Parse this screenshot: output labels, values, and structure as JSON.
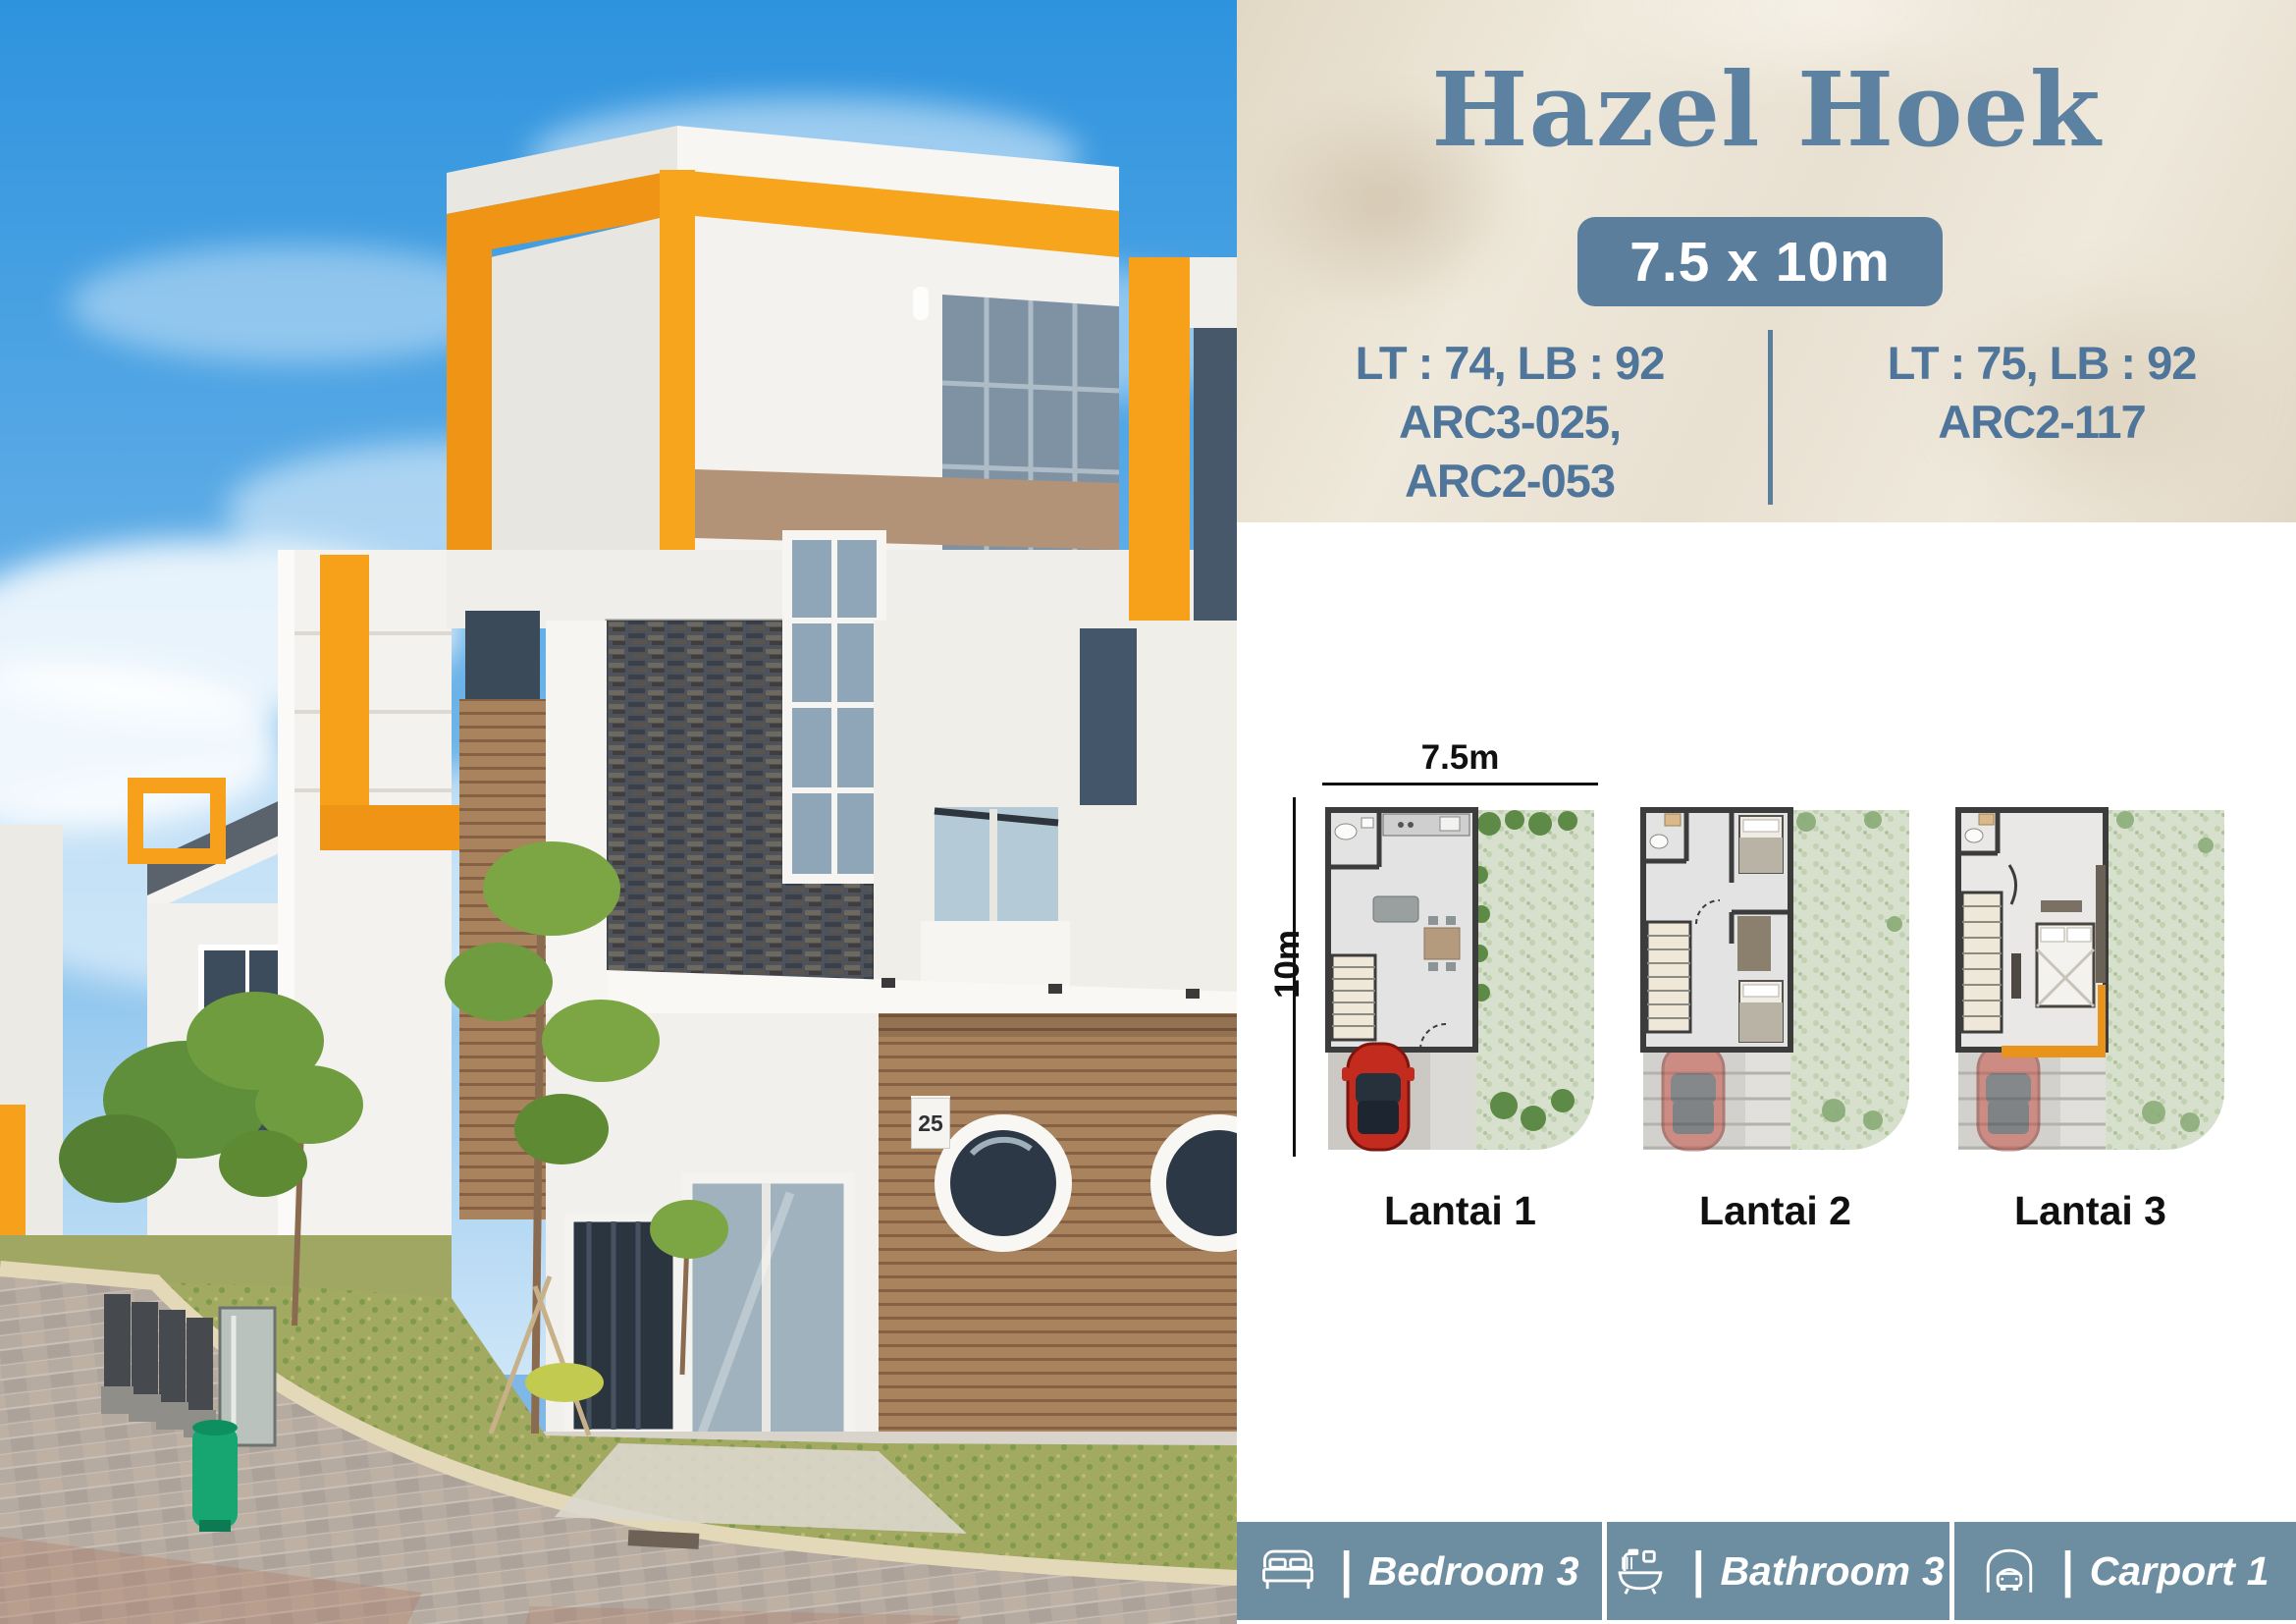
{
  "colors": {
    "accent_slate": "#5d81a0",
    "badge_bg": "#5b7e9c",
    "feature_bar_bg": "#6d8ea1",
    "header_beige": "#eae3d6",
    "accent_orange": "#f6a01b"
  },
  "header": {
    "title": "Hazel Hoek",
    "size_badge": "7.5 x 10m",
    "specs_left": [
      "LT : 74, LB : 92",
      "ARC3-025,",
      "ARC2-053"
    ],
    "specs_right": [
      "LT : 75, LB : 92",
      "ARC2-117"
    ]
  },
  "floorplans": {
    "width_label": "7.5m",
    "depth_label": "10m",
    "items": [
      {
        "label": "Lantai 1"
      },
      {
        "label": "Lantai 2"
      },
      {
        "label": "Lantai 3"
      }
    ]
  },
  "features": {
    "separator": "|",
    "items": [
      {
        "icon": "bed-icon",
        "label": "Bedroom",
        "count": "3"
      },
      {
        "icon": "bathtub-icon",
        "label": "Bathroom",
        "count": "3"
      },
      {
        "icon": "carport-icon",
        "label": "Carport",
        "count": "1"
      }
    ]
  },
  "photo": {
    "house_number": "25"
  }
}
